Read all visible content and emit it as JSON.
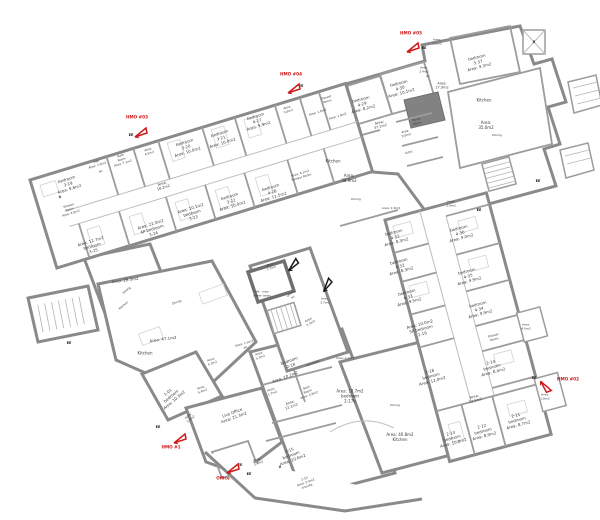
{
  "title": "HMO conversion floor plan",
  "colors": {
    "wall": "#8a8a8a",
    "red": "#cc1a1a",
    "black_flag": "#1a1a1a",
    "text": "#3a3a3a"
  },
  "flags": [
    {
      "name": "hmo-03-marker",
      "color": "red",
      "x": 141,
      "y": 131,
      "rot": 0,
      "label": "HMO #03",
      "lx": 137,
      "ly": 117
    },
    {
      "name": "hmo-04-marker",
      "color": "red",
      "x": 294,
      "y": 87,
      "rot": 0,
      "label": "HMO #04",
      "lx": 291,
      "ly": 74
    },
    {
      "name": "hmo-05-marker",
      "color": "red",
      "x": 413,
      "y": 46,
      "rot": 0,
      "label": "HMO #05",
      "lx": 411,
      "ly": 33
    },
    {
      "name": "hmo-02-marker",
      "color": "red",
      "x": 545,
      "y": 384,
      "rot": 80,
      "label": "HMO #02",
      "lx": 568,
      "ly": 379
    },
    {
      "name": "hmo-1-marker",
      "color": "red",
      "x": 180,
      "y": 437,
      "rot": 0,
      "label": "HMO #1",
      "lx": 171,
      "ly": 447
    },
    {
      "name": "office-marker",
      "color": "red",
      "x": 233,
      "y": 467,
      "rot": 0,
      "label": "Office",
      "lx": 223,
      "ly": 478
    },
    {
      "name": "black-flag-1",
      "color": "black",
      "x": 293,
      "y": 263,
      "rot": -20,
      "label": ""
    },
    {
      "name": "black-flag-2",
      "color": "black",
      "x": 327,
      "y": 283,
      "rot": -30,
      "label": ""
    }
  ],
  "exit_labels": [
    {
      "text": "EE",
      "x": 131,
      "y": 135
    },
    {
      "text": "EE",
      "x": 301,
      "y": 86
    },
    {
      "text": "EE",
      "x": 424,
      "y": 48
    },
    {
      "text": "EE",
      "x": 69,
      "y": 343
    },
    {
      "text": "EE",
      "x": 479,
      "y": 210
    },
    {
      "text": "EE",
      "x": 538,
      "y": 181
    },
    {
      "text": "EE",
      "x": 534,
      "y": 378
    },
    {
      "text": "EE",
      "x": 240,
      "y": 465
    },
    {
      "text": "EE",
      "x": 249,
      "y": 474
    },
    {
      "text": "EE",
      "x": 158,
      "y": 427
    }
  ],
  "labels": [
    {
      "lines": [
        "bedroom",
        "3-19",
        "Area: 9.6m2"
      ],
      "x": 68,
      "y": 184,
      "rot": -17
    },
    {
      "lines": [
        "B"
      ],
      "x": 60,
      "y": 197,
      "rot": -17,
      "size": 3.2,
      "bold": true
    },
    {
      "lines": [
        "Hall",
        "Area: 2.6m2"
      ],
      "x": 97,
      "y": 164,
      "rot": -17,
      "size": 3
    },
    {
      "lines": [
        "wc"
      ],
      "x": 101,
      "y": 172,
      "rot": -17,
      "size": 3
    },
    {
      "lines": [
        "Bath",
        "Room",
        "Area: 7.1m2"
      ],
      "x": 122,
      "y": 160,
      "rot": -17,
      "size": 3
    },
    {
      "lines": [
        "Area:",
        "4.5m2"
      ],
      "x": 149,
      "y": 152,
      "rot": -17,
      "size": 3
    },
    {
      "lines": [
        "bedroom",
        "3-20",
        "Area: 10.0m2"
      ],
      "x": 186,
      "y": 147,
      "rot": -17
    },
    {
      "lines": [
        "bedroom",
        "3-21",
        "Area: 10.0m2"
      ],
      "x": 221,
      "y": 138,
      "rot": -17
    },
    {
      "lines": [
        "bedroom",
        "4-27",
        "Area: 9.9m2"
      ],
      "x": 257,
      "y": 121,
      "rot": -17
    },
    {
      "lines": [
        "Area:",
        "5.6m2"
      ],
      "x": 288,
      "y": 110,
      "rot": -17,
      "size": 3
    },
    {
      "lines": [
        "Shower",
        "Room"
      ],
      "x": 327,
      "y": 100,
      "rot": -17,
      "size": 3
    },
    {
      "lines": [
        "Area: 1.6m2"
      ],
      "x": 318,
      "y": 113,
      "rot": -17,
      "size": 3
    },
    {
      "lines": [
        "Area: 1.8m2"
      ],
      "x": 338,
      "y": 117,
      "rot": -17,
      "size": 3
    },
    {
      "lines": [
        "Area:",
        "18.2m2"
      ],
      "x": 163,
      "y": 186,
      "rot": -17,
      "size": 3.5
    },
    {
      "lines": [
        "Shower",
        "Room",
        "Area: 4.0m2"
      ],
      "x": 70,
      "y": 210,
      "rot": -17,
      "size": 3
    },
    {
      "lines": [
        "Area: 12.7m2",
        "bedroom",
        "3-25"
      ],
      "x": 92,
      "y": 246,
      "rot": -17
    },
    {
      "lines": [
        "Area: 22.0m2",
        "4P bedroom",
        "3-24"
      ],
      "x": 152,
      "y": 229,
      "rot": -17
    },
    {
      "lines": [
        "Area: 10.1m2",
        "bedroom",
        "3-23"
      ],
      "x": 192,
      "y": 213,
      "rot": -17
    },
    {
      "lines": [
        "bedroom",
        "3-22",
        "Area: 10.0m2"
      ],
      "x": 231,
      "y": 201,
      "rot": -17
    },
    {
      "lines": [
        "bedroom",
        "4-28",
        "Area: 11.5m2"
      ],
      "x": 272,
      "y": 192,
      "rot": -17
    },
    {
      "lines": [
        "bedroom",
        "4-29",
        "Area: 8.2m2"
      ],
      "x": 362,
      "y": 104,
      "rot": -15
    },
    {
      "lines": [
        "bedroom",
        "4-30",
        "Area: 10.1m2"
      ],
      "x": 400,
      "y": 88,
      "rot": -15
    },
    {
      "lines": [
        "Area:",
        "2.4m2"
      ],
      "x": 424,
      "y": 70,
      "rot": 0,
      "size": 3
    },
    {
      "lines": [
        "wc"
      ],
      "x": 428,
      "y": 77,
      "rot": 0,
      "size": 3
    },
    {
      "lines": [
        "Area:",
        "2.0m2"
      ],
      "x": 437,
      "y": 42,
      "rot": 0,
      "size": 3
    },
    {
      "lines": [
        "bedroom",
        "5-37",
        "Area: 9.3m2"
      ],
      "x": 478,
      "y": 62,
      "rot": -15
    },
    {
      "lines": [
        "Area:",
        "17.9m2"
      ],
      "x": 442,
      "y": 86,
      "rot": 0,
      "size": 3.5
    },
    {
      "lines": [
        "Kitchen"
      ],
      "x": 484,
      "y": 100,
      "rot": 0
    },
    {
      "lines": [
        "Area:",
        "35.0m2"
      ],
      "x": 486,
      "y": 125,
      "rot": 0
    },
    {
      "lines": [
        "Dining"
      ],
      "x": 497,
      "y": 136,
      "rot": 0,
      "size": 3
    },
    {
      "lines": [
        "Movie",
        "Room"
      ],
      "x": 417,
      "y": 122,
      "rot": -15,
      "size": 3
    },
    {
      "lines": [
        "Area:",
        "9.5m2"
      ],
      "x": 406,
      "y": 134,
      "rot": -15,
      "size": 3
    },
    {
      "lines": [
        "store"
      ],
      "x": 409,
      "y": 153,
      "rot": -15,
      "size": 3
    },
    {
      "lines": [
        "Area:",
        "37.1m2"
      ],
      "x": 380,
      "y": 125,
      "rot": -15,
      "size": 3.5
    },
    {
      "lines": [
        "Kitchen"
      ],
      "x": 333,
      "y": 161,
      "rot": 0
    },
    {
      "lines": [
        "Area:",
        "38.9m2"
      ],
      "x": 349,
      "y": 178,
      "rot": 0
    },
    {
      "lines": [
        "Dining"
      ],
      "x": 356,
      "y": 200,
      "rot": 0,
      "size": 3
    },
    {
      "lines": [
        "Area: 1.5m2"
      ],
      "x": 391,
      "y": 209,
      "rot": 0,
      "size": 3
    },
    {
      "lines": [
        "B"
      ],
      "x": 534,
      "y": 42,
      "rot": 0,
      "size": 3.5,
      "bold": true
    },
    {
      "lines": [
        "Area:",
        "2.9m2"
      ],
      "x": 451,
      "y": 204,
      "rot": 0,
      "size": 3
    },
    {
      "lines": [
        "bedroom",
        "4-31",
        "Area: 8.3m2"
      ],
      "x": 395,
      "y": 237,
      "rot": -15
    },
    {
      "lines": [
        "bedroom",
        "4-32",
        "Area: 8.3m2"
      ],
      "x": 400,
      "y": 266,
      "rot": -15
    },
    {
      "lines": [
        "bedroom",
        "4-33",
        "Area: 9.5m2"
      ],
      "x": 408,
      "y": 297,
      "rot": -15
    },
    {
      "lines": [
        "Area: 10.0m2",
        "5P bedroom",
        "2-19"
      ],
      "x": 421,
      "y": 329,
      "rot": -15
    },
    {
      "lines": [
        "2-18",
        "bedroom",
        "Area: 12.0m2"
      ],
      "x": 431,
      "y": 376,
      "rot": -15
    },
    {
      "lines": [
        "bedroom",
        "4-36",
        "Area: 9.0m2"
      ],
      "x": 460,
      "y": 233,
      "rot": -15
    },
    {
      "lines": [
        "bedroom",
        "4-35",
        "Area: 9.9m2"
      ],
      "x": 468,
      "y": 276,
      "rot": -15
    },
    {
      "lines": [
        "bedroom",
        "4-34",
        "Area: 9.9m2"
      ],
      "x": 479,
      "y": 309,
      "rot": -15
    },
    {
      "lines": [
        "Shower",
        "Room"
      ],
      "x": 494,
      "y": 338,
      "rot": -15,
      "size": 3
    },
    {
      "lines": [
        "Area:",
        "4.0m2"
      ],
      "x": 526,
      "y": 327,
      "rot": 0,
      "size": 3
    },
    {
      "lines": [
        "2-14",
        "bedroom",
        "Area: 8.4m2"
      ],
      "x": 492,
      "y": 367,
      "rot": -15
    },
    {
      "lines": [
        "Area:",
        "13.5m2"
      ],
      "x": 475,
      "y": 399,
      "rot": -15,
      "size": 3.5
    },
    {
      "lines": [
        "Area:",
        "1.8m2"
      ],
      "x": 545,
      "y": 397,
      "rot": 0,
      "size": 3
    },
    {
      "lines": [
        "2-11",
        "bedroom",
        "Area: 8.7m2"
      ],
      "x": 517,
      "y": 420,
      "rot": -15
    },
    {
      "lines": [
        "2-12",
        "bedroom",
        "Area: 8.9m2"
      ],
      "x": 483,
      "y": 431,
      "rot": -15
    },
    {
      "lines": [
        "2-13",
        "bedroom",
        "Area: 10.8m2"
      ],
      "x": 452,
      "y": 438,
      "rot": -15
    },
    {
      "lines": [
        "Area:",
        "5.3m2"
      ],
      "x": 260,
      "y": 356,
      "rot": -20,
      "size": 3
    },
    {
      "lines": [
        "bedroom",
        "2-16"
      ],
      "x": 290,
      "y": 363,
      "rot": -20
    },
    {
      "lines": [
        "wardrobe"
      ],
      "x": 313,
      "y": 364,
      "rot": -20,
      "size": 3
    },
    {
      "lines": [
        "Area: 10.2m2"
      ],
      "x": 285,
      "y": 377,
      "rot": -20
    },
    {
      "lines": [
        "Area:",
        "1.7m2"
      ],
      "x": 272,
      "y": 392,
      "rot": -20,
      "size": 3
    },
    {
      "lines": [
        "Bath",
        "Room",
        "Area: 3.9m2"
      ],
      "x": 308,
      "y": 392,
      "rot": -20,
      "size": 3
    },
    {
      "lines": [
        "Area:",
        "12.1m2"
      ],
      "x": 291,
      "y": 405,
      "rot": -20,
      "size": 3.5
    },
    {
      "lines": [
        "Area: 2.1m2"
      ],
      "x": 345,
      "y": 359,
      "rot": 0,
      "size": 3
    },
    {
      "lines": [
        "Area: 10.7m2",
        "bedroom",
        "2-17b"
      ],
      "x": 350,
      "y": 396,
      "rot": 0
    },
    {
      "lines": [
        "Dining"
      ],
      "x": 395,
      "y": 406,
      "rot": 0,
      "size": 3
    },
    {
      "lines": [
        "Area: 40.8m2",
        "Kitchen"
      ],
      "x": 400,
      "y": 437,
      "rot": 0
    },
    {
      "lines": [
        "2-15",
        "bedroom",
        "Area: 10.6m2"
      ],
      "x": 291,
      "y": 455,
      "rot": -20
    },
    {
      "lines": [
        "B"
      ],
      "x": 280,
      "y": 467,
      "rot": -20,
      "size": 3.2,
      "bold": true
    },
    {
      "lines": [
        "2-10",
        "Area: 5.4m2",
        "ensuite"
      ],
      "x": 306,
      "y": 483,
      "rot": -20,
      "size": 3
    },
    {
      "lines": [
        "Live Office",
        "Area: 21.3m2"
      ],
      "x": 233,
      "y": 415,
      "rot": -20
    },
    {
      "lines": [
        "Area:",
        "3.4m2"
      ],
      "x": 258,
      "y": 462,
      "rot": -20,
      "size": 3
    },
    {
      "lines": [
        "Area:",
        "4.3m2"
      ],
      "x": 212,
      "y": 362,
      "rot": -20,
      "size": 3
    },
    {
      "lines": [
        "Area:",
        "4.4m2"
      ],
      "x": 202,
      "y": 390,
      "rot": -20,
      "size": 3
    },
    {
      "lines": [
        "1-01",
        "bedroom",
        "Area: 10.3m2"
      ],
      "x": 171,
      "y": 396,
      "rot": -40
    },
    {
      "lines": [
        "Area:",
        "1.0m2"
      ],
      "x": 190,
      "y": 418,
      "rot": -40,
      "size": 3
    },
    {
      "lines": [
        "Kitchen"
      ],
      "x": 145,
      "y": 353,
      "rot": 0
    },
    {
      "lines": [
        "Area: 47.1m2"
      ],
      "x": 163,
      "y": 339,
      "rot": -8
    },
    {
      "lines": [
        "Dining"
      ],
      "x": 177,
      "y": 303,
      "rot": -20,
      "size": 3
    },
    {
      "lines": [
        "Area: 28.3m2"
      ],
      "x": 125,
      "y": 280,
      "rot": -8
    },
    {
      "lines": [
        "Dining"
      ],
      "x": 127,
      "y": 291,
      "rot": -40,
      "size": 3
    },
    {
      "lines": [
        "Kitchen"
      ],
      "x": 124,
      "y": 306,
      "rot": -40,
      "size": 3
    },
    {
      "lines": [
        "Area:",
        "1.7m2"
      ],
      "x": 271,
      "y": 267,
      "rot": -17,
      "size": 3
    },
    {
      "lines": [
        "lift - new",
        "water tanks"
      ],
      "x": 262,
      "y": 294,
      "rot": 0,
      "size": 3
    },
    {
      "lines": [
        "office",
        "wc"
      ],
      "x": 292,
      "y": 296,
      "rot": -40,
      "size": 3
    },
    {
      "lines": [
        "Area:",
        "3.7m2"
      ],
      "x": 325,
      "y": 301,
      "rot": 0,
      "size": 3
    },
    {
      "lines": [
        "Area:",
        "5.3m2"
      ],
      "x": 310,
      "y": 322,
      "rot": -30,
      "size": 3
    },
    {
      "lines": [
        "Area: 1.5m2",
        "wc"
      ],
      "x": 245,
      "y": 346,
      "rot": -17,
      "size": 3
    },
    {
      "lines": [
        "Area: 4.1m2",
        "Shower Room"
      ],
      "x": 301,
      "y": 176,
      "rot": -17,
      "size": 3
    }
  ]
}
